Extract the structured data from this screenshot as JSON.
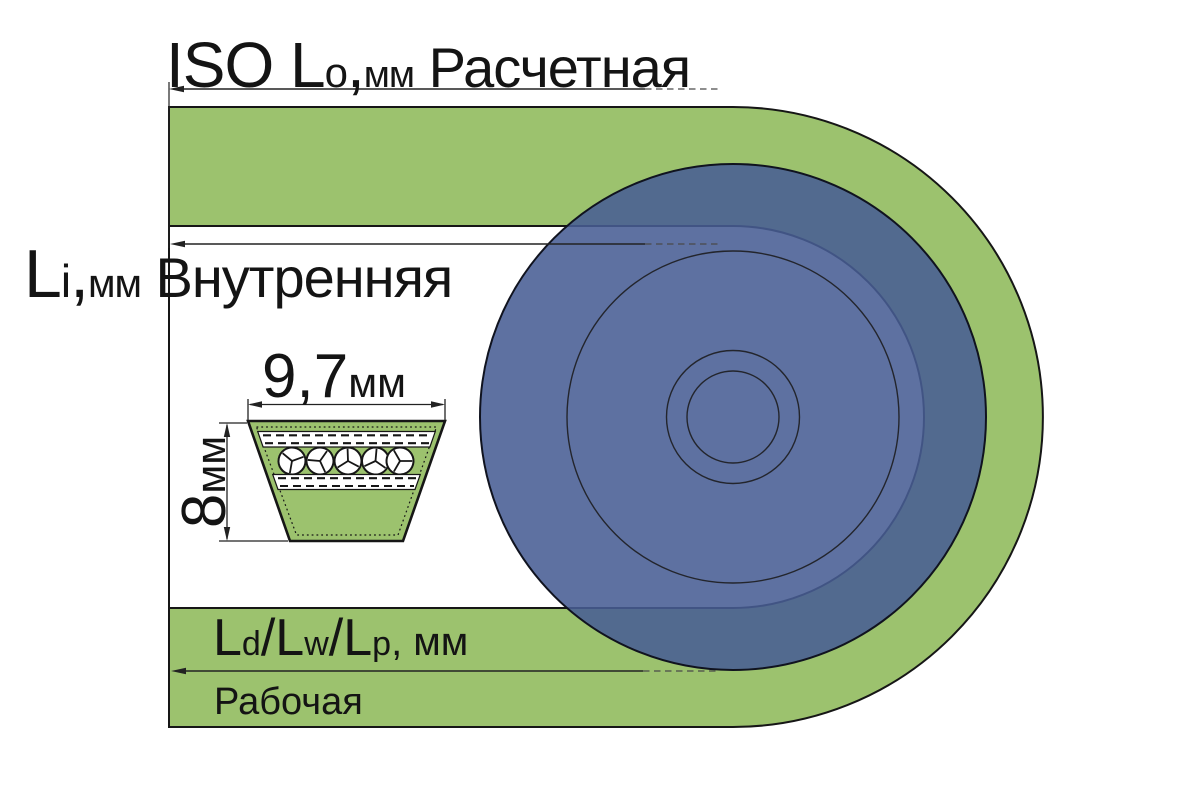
{
  "title": "V-belt and pulley length designation diagram",
  "colors": {
    "belt_green": "#9cc26e",
    "belt_outline": "#161616",
    "pulley_blue": "#485d94",
    "pulley_outline": "#10131f",
    "thin_circle": "#23252c",
    "line_color": "#222222",
    "dash_color": "#4a4a4a",
    "text_color": "#141414",
    "cord_white": "#ffffff"
  },
  "labels": {
    "outer_length": {
      "segments": [
        {
          "text": "ISO L",
          "cls": "s64"
        },
        {
          "text": "o",
          "cls": "s42"
        },
        {
          "text": ",",
          "cls": "s64"
        },
        {
          "text": "мм",
          "cls": "s38"
        },
        {
          "text": " Расчетная",
          "cls": "s56"
        }
      ]
    },
    "inner_length": {
      "segments": [
        {
          "text": "L",
          "cls": "s68"
        },
        {
          "text": "i",
          "cls": "s46"
        },
        {
          "text": ",",
          "cls": "s68"
        },
        {
          "text": "мм",
          "cls": "s40"
        },
        {
          "text": " Внутренняя",
          "cls": "s56"
        }
      ]
    },
    "belt_width": {
      "segments": [
        {
          "text": "9,7",
          "cls": "s62"
        },
        {
          "text": "мм",
          "cls": "s42"
        }
      ]
    },
    "belt_height": {
      "segments": [
        {
          "text": "8",
          "cls": "s62"
        },
        {
          "text": "мм",
          "cls": "s42"
        }
      ]
    },
    "pitch_length": {
      "segments": [
        {
          "text": "L",
          "cls": "s52"
        },
        {
          "text": "d",
          "cls": "s34"
        },
        {
          "text": "/L",
          "cls": "s52"
        },
        {
          "text": "w",
          "cls": "s34"
        },
        {
          "text": "/L",
          "cls": "s52"
        },
        {
          "text": "p",
          "cls": "s34"
        },
        {
          "text": ", мм",
          "cls": "s40"
        }
      ]
    },
    "working_length": {
      "segments": [
        {
          "text": "Рабочая",
          "cls": "s38"
        }
      ]
    }
  }
}
